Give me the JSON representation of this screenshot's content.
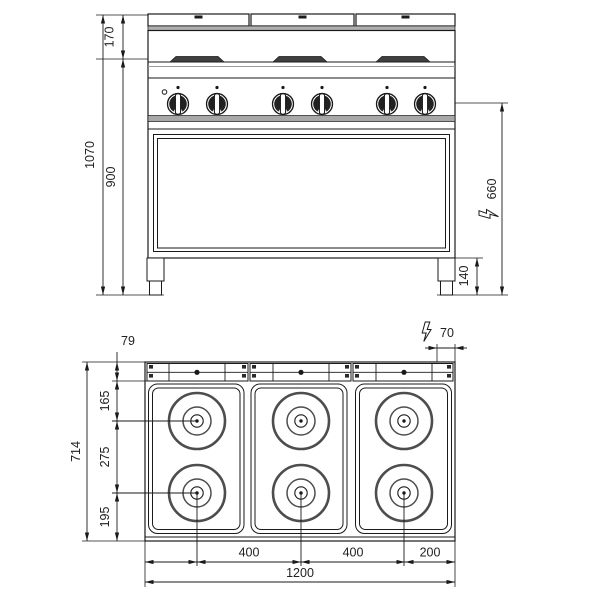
{
  "front_view": {
    "dim_top_section_height": "170",
    "dim_total_height": "1070",
    "dim_body_height": "900",
    "dim_electric_inlet_height": "660",
    "dim_leg_height": "140"
  },
  "plan_view": {
    "dim_back_rail_depth": "79",
    "dim_electric_inlet_right_offset": "70",
    "dim_total_depth": "714",
    "dim_back_to_row1_center": "165",
    "dim_row1_to_row2_center": "275",
    "dim_row2_center_to_front": "195",
    "dim_col1_to_col2_center": "400",
    "dim_col2_to_col3_center": "400",
    "dim_col3_center_to_right": "200",
    "dim_total_width": "1200"
  },
  "icons": {
    "electric_connection": "lightning-bolt"
  },
  "colors": {
    "ink": "#1a1a1a",
    "gray_band": "#ababab",
    "burner_ring": "#4d4d4d"
  }
}
